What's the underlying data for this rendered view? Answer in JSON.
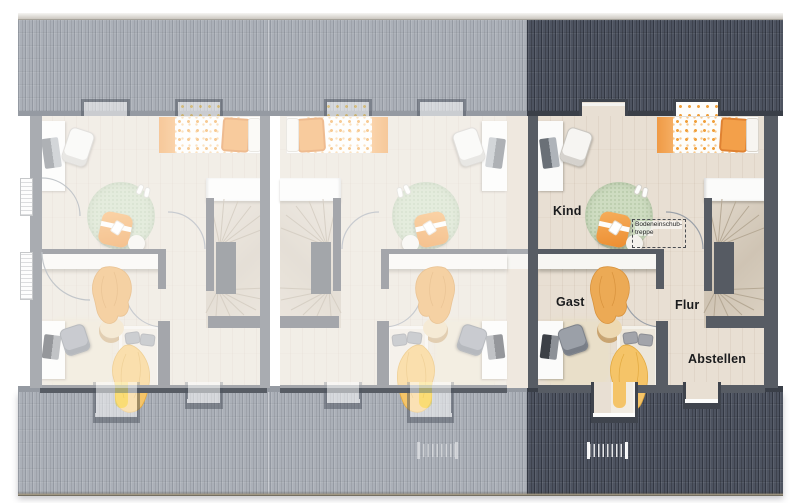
{
  "plan": {
    "type": "floorplan-top-view",
    "highlighted_unit": "right",
    "units": [
      {
        "name": "left",
        "highlighted": false,
        "mirrored": false
      },
      {
        "name": "middle",
        "highlighted": false,
        "mirrored": true
      },
      {
        "name": "right",
        "highlighted": true,
        "mirrored": false
      }
    ]
  },
  "rooms": {
    "kind": "Kind",
    "gast": "Gast",
    "flur": "Flur",
    "abstellen": "Abstellen"
  },
  "attic_hatch": {
    "line1": "Bodeneinschub-",
    "line2": "treppe"
  },
  "colors": {
    "roof_highlighted": "#4d5360",
    "roof_inactive": "#abb0b8",
    "wall": "#575c64",
    "wall_inactive": "#a9acb1",
    "floor": "#e8dfd3",
    "floor_inactive": "#efe8df",
    "rug_green": "#cedcc1",
    "accent_orange": "#f0953f",
    "blanket_yellow": "#f4c468",
    "label_text": "#1a1b1d"
  }
}
